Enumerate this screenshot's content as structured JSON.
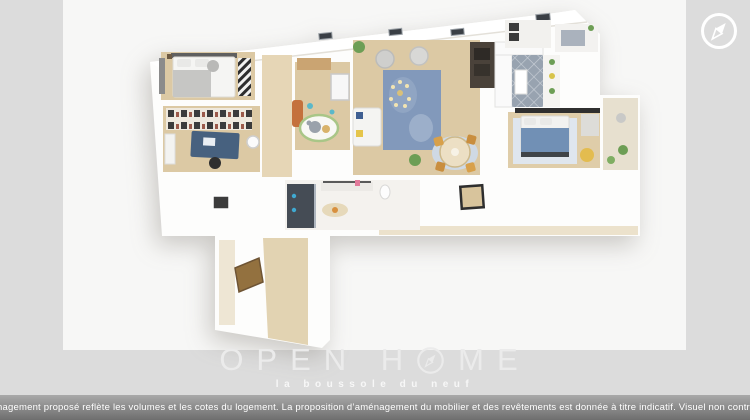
{
  "viewer": {
    "compass_button": {
      "icon": "compass"
    }
  },
  "watermark": {
    "brand_part1": "OPEN H",
    "brand_part2": "ME",
    "tagline": "la boussole du neuf"
  },
  "footer": {
    "disclaimer": "L’aménagement proposé reflète les volumes et les cotes du logement. La proposition d’aménagement du mobilier et des revêtements est donnée à titre indicatif. Visuel non contractuel."
  },
  "colors": {
    "canvas_gray": "#dcdcdc",
    "photo_bg": "#f7f7f6",
    "footer_top": "#a9a9a9",
    "footer_bottom": "#6e6e6e",
    "footer_text": "#ffffff",
    "watermark_text": "#ebebeb",
    "compass_white": "#ffffff",
    "wood_floor": "#dcc9a4",
    "tile_floor": "#98a3b0",
    "rug_blue": "#8299bb"
  }
}
